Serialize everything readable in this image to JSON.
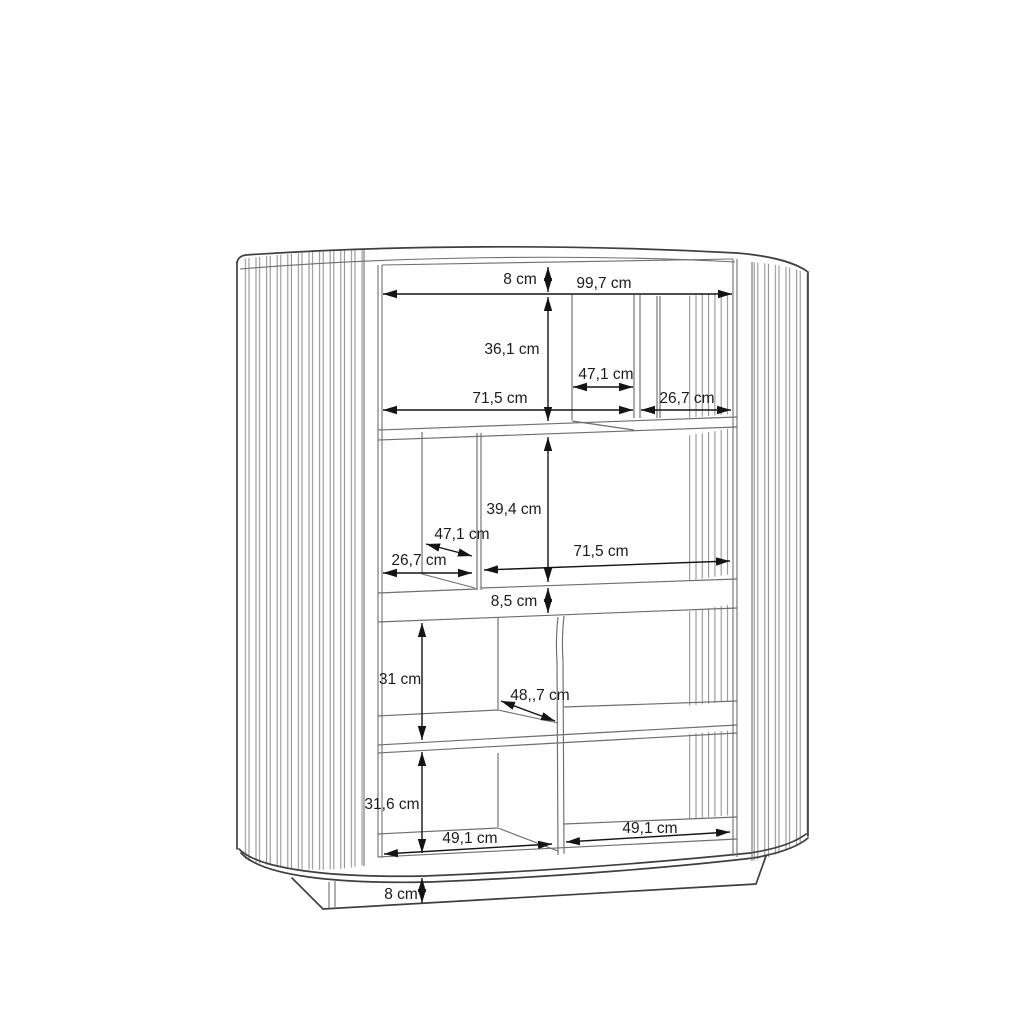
{
  "drawing": {
    "type": "furniture-dimension-diagram",
    "subject": "fluted sliding-door highboard cabinet, front elevation with internal dimensions",
    "unit": "cm"
  },
  "colors": {
    "background": "#ffffff",
    "outline": "#3f3f3f",
    "interior_lines": "#6e6e6e",
    "slats": "#8a8a8a",
    "dimensions": "#141414"
  },
  "dimensions": {
    "top_frame_height": "8 cm",
    "interior_width": "99,7 cm",
    "upper_section_height": "36,1 cm",
    "upper_partition_depth": "47,1 cm",
    "upper_left_compartment_width": "71,5 cm",
    "upper_right_compartment_width": "26,7 cm",
    "middle_section_height": "39,4 cm",
    "middle_partition_depth": "47,1 cm",
    "middle_left_compartment_width": "26,7 cm",
    "middle_right_compartment_width": "71,5 cm",
    "divider_band_height": "8,5 cm",
    "lower_section_height": "31 cm",
    "lower_shelf_depth": "48,,7 cm",
    "bottom_section_height": "31,6 cm",
    "bottom_left_compartment_width": "49,1 cm",
    "bottom_right_compartment_width": "49,1 cm",
    "plinth_height": "8 cm"
  }
}
